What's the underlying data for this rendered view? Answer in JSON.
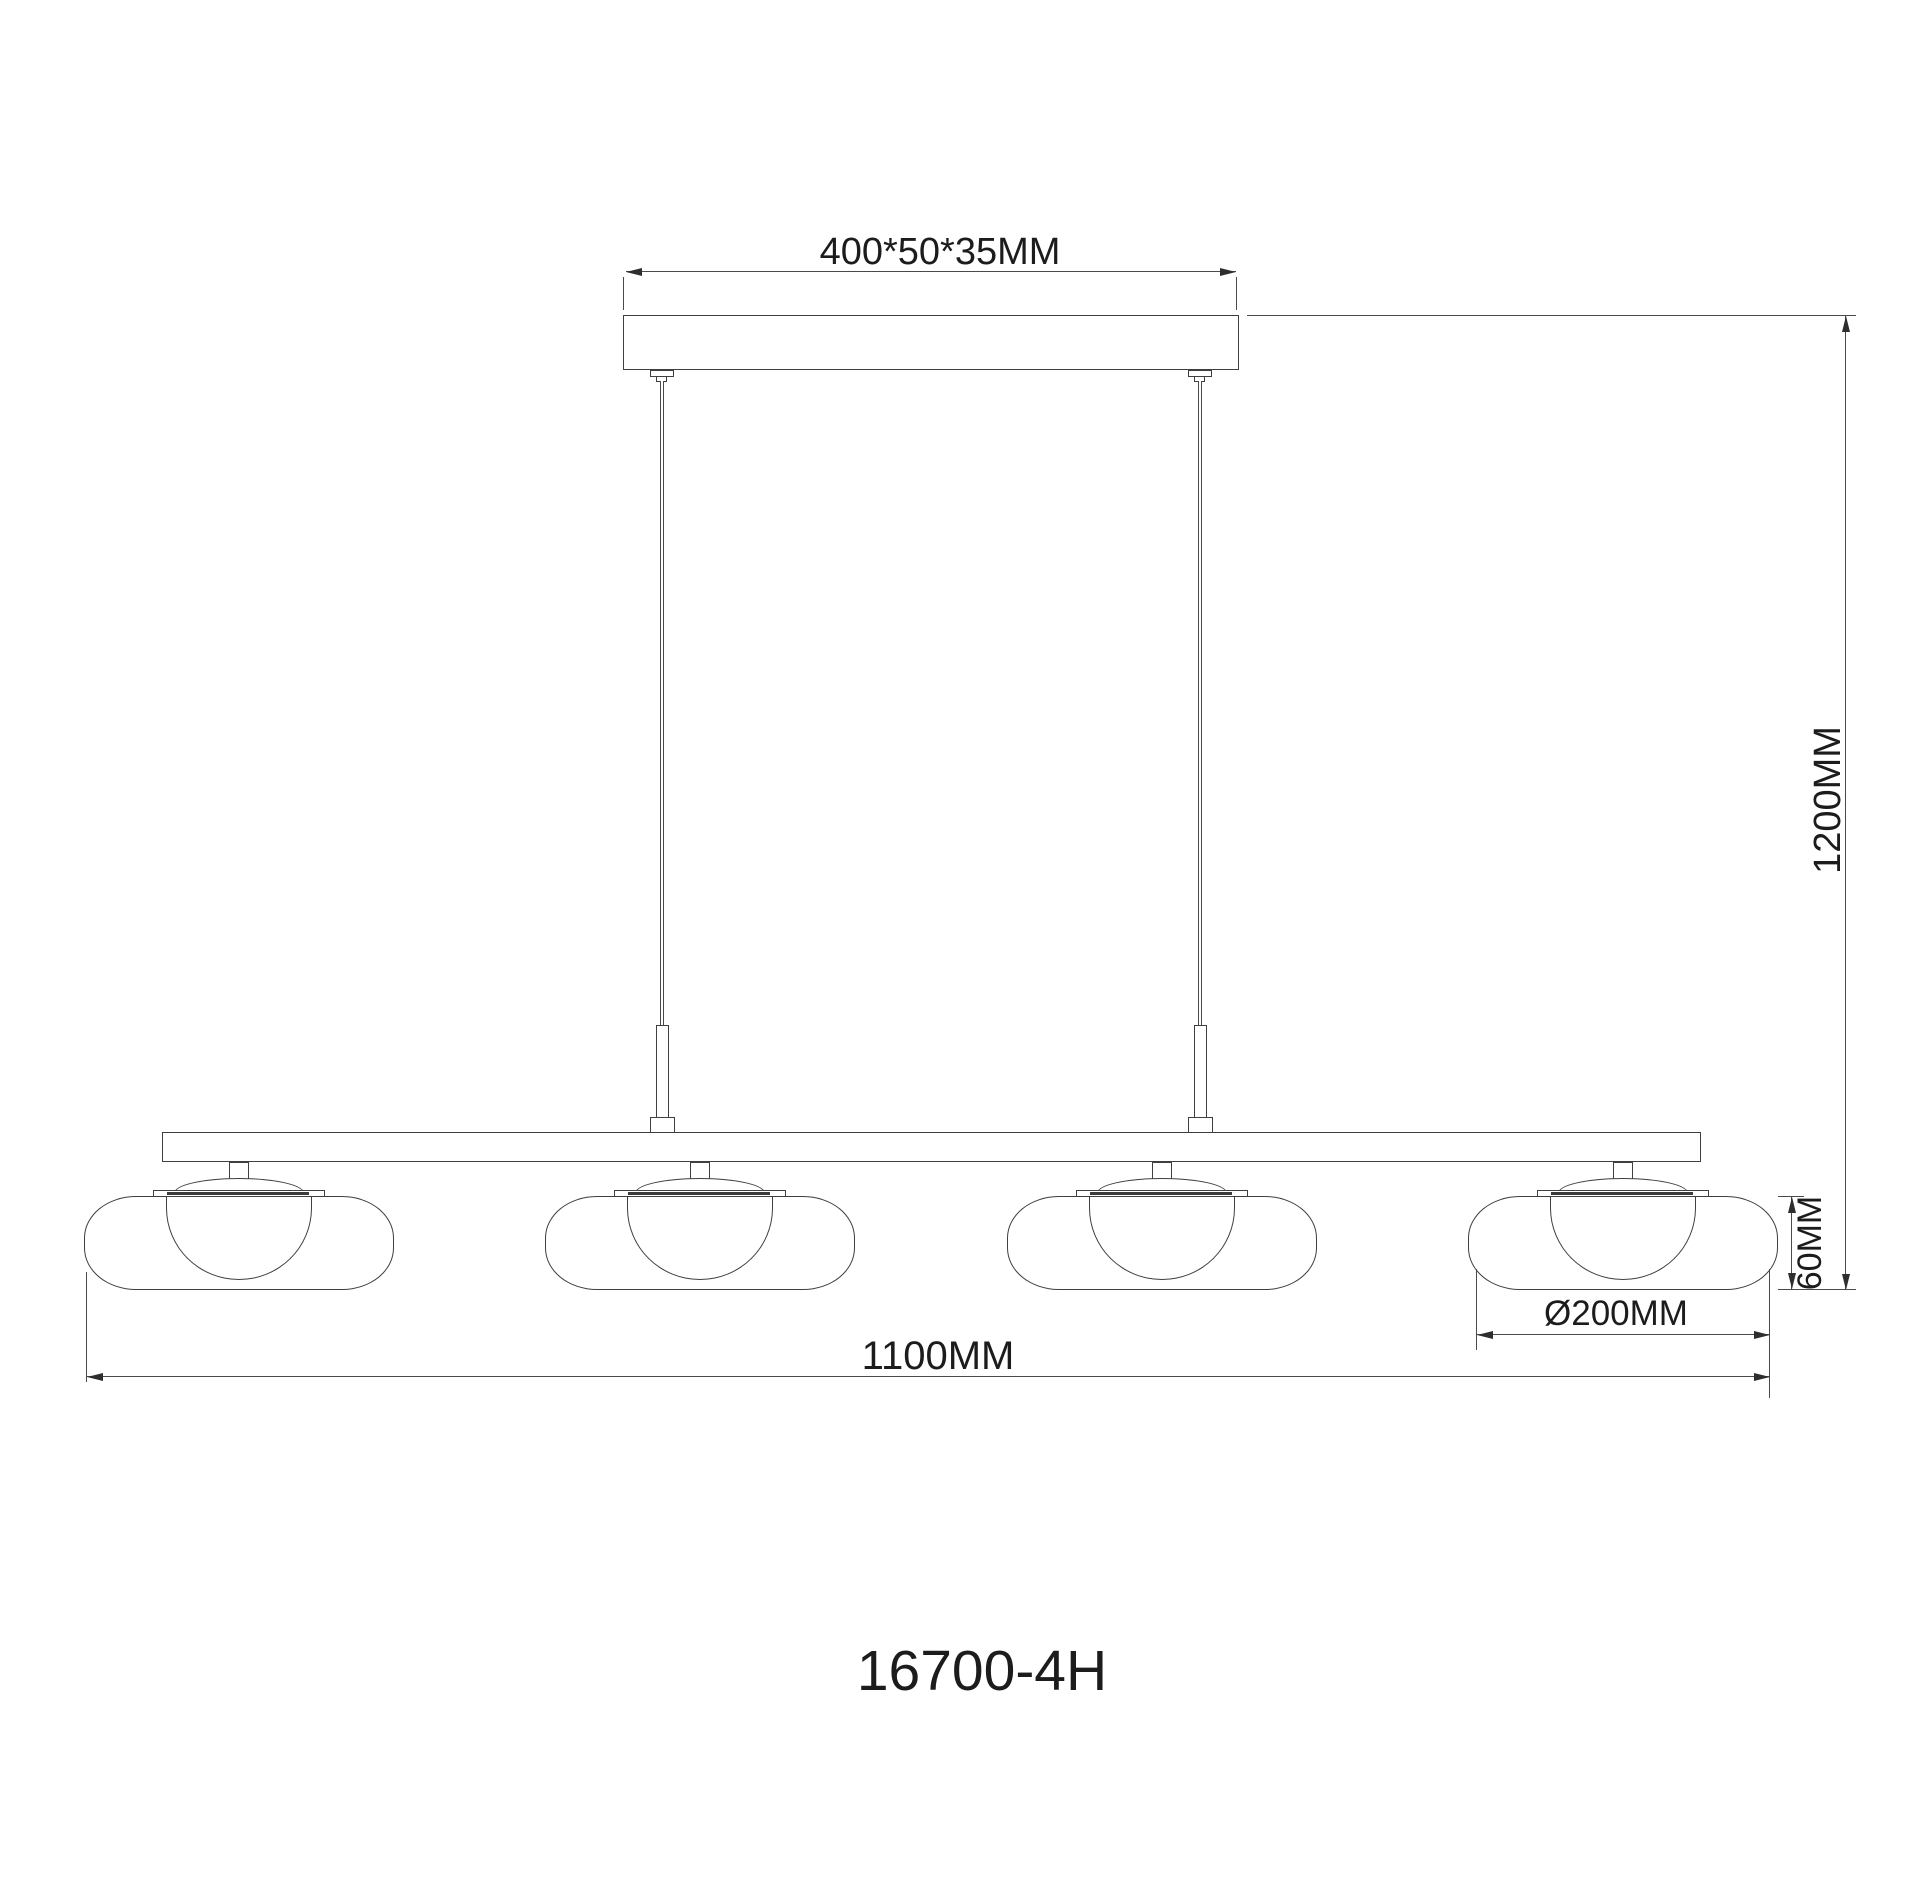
{
  "drawing": {
    "model_number": "16700-4H",
    "lamp_count": 4,
    "dimensions": {
      "canopy_size": "400*50*35MM",
      "suspension_height": "1200MM",
      "shade_height": "60MM",
      "shade_diameter": "Ø200MM",
      "overall_width": "1100MM"
    }
  },
  "colors": {
    "background": "#ffffff",
    "object_line": "#3f3f3f",
    "dimension_line": "#4a4a4a",
    "text": "#1c1c1c"
  }
}
